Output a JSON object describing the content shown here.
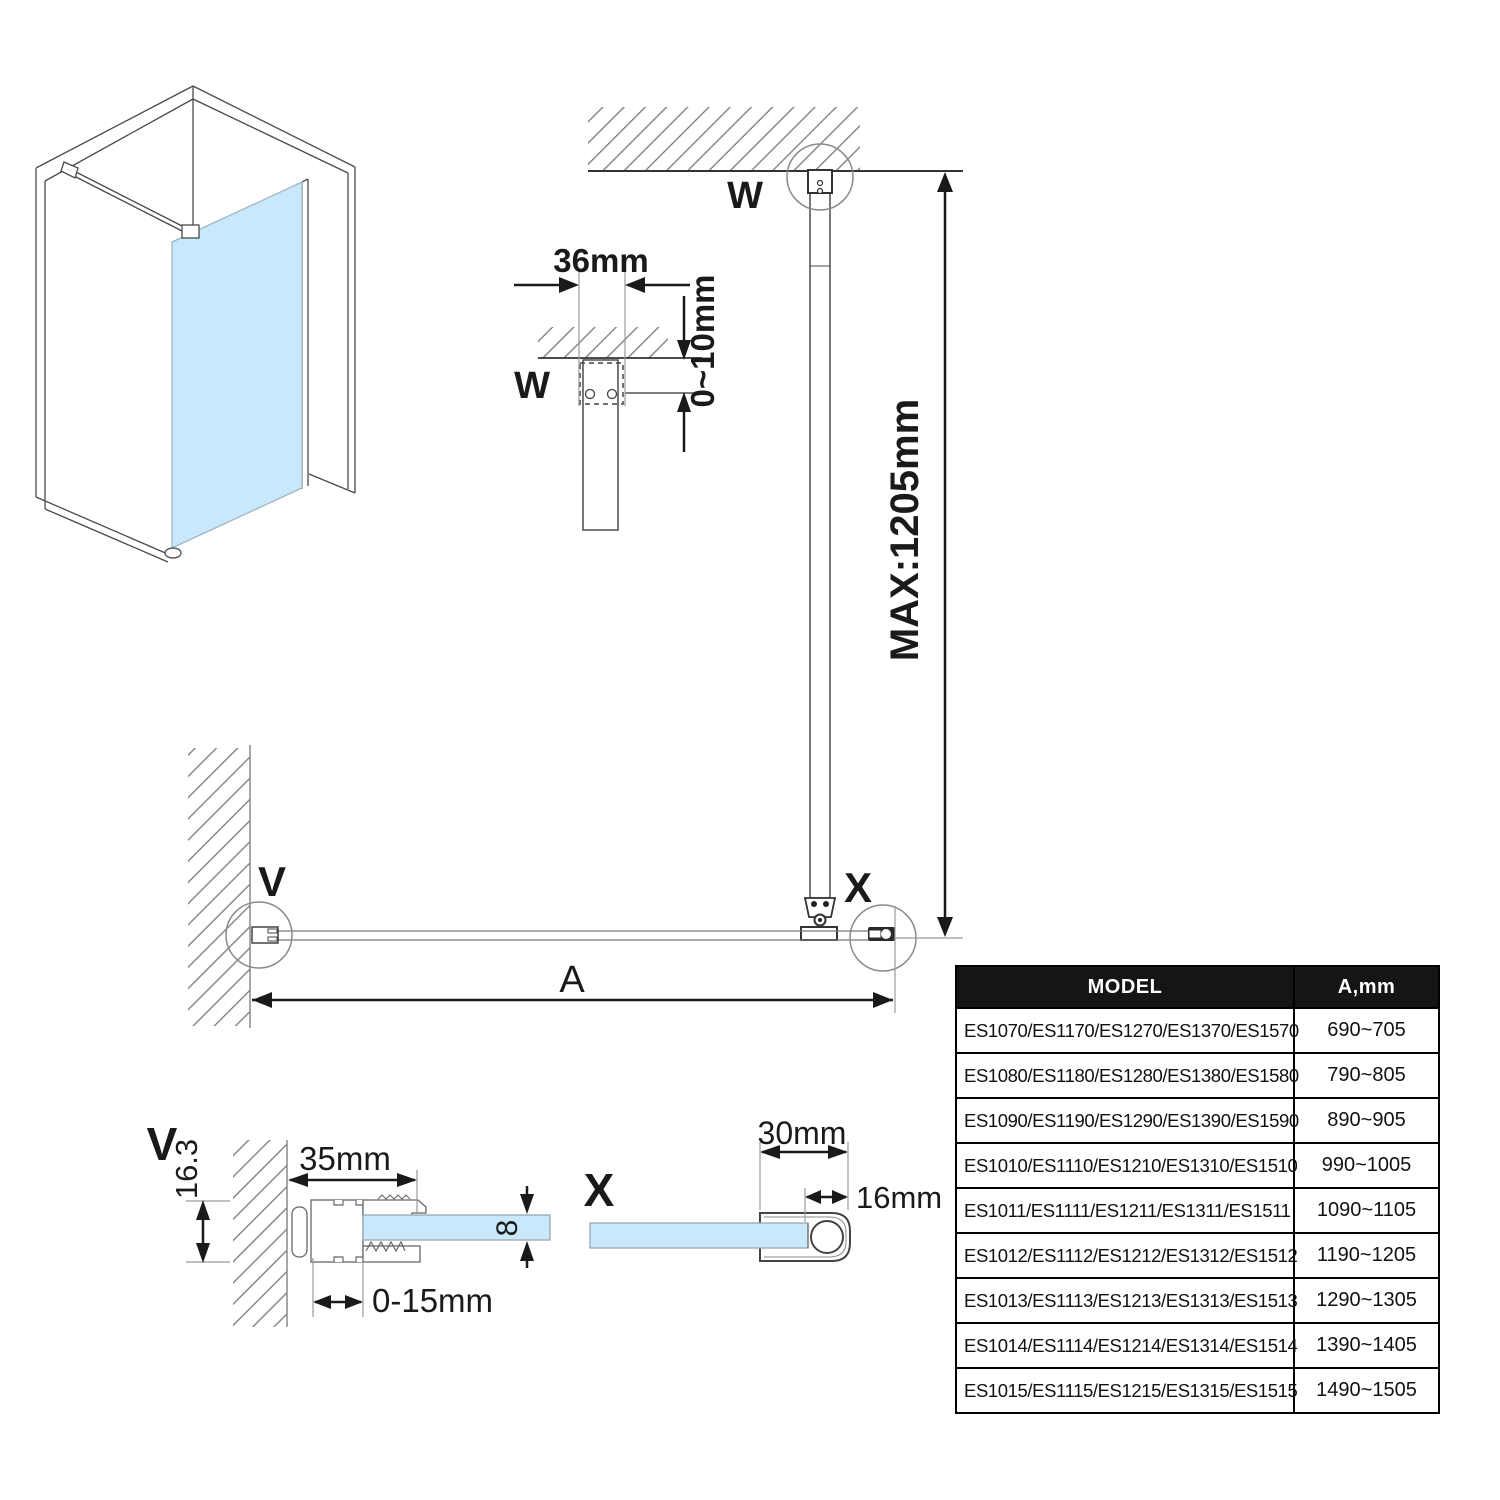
{
  "diagram": {
    "labels": {
      "w_main": "W",
      "w_small": "W",
      "v_plan": "V",
      "x_plan": "X",
      "v_section": "V",
      "x_section": "X",
      "dim_a": "A"
    },
    "dimensions": {
      "bracket_width": "36mm",
      "ceiling_gap": "0~10mm",
      "max_bar_length": "MAX:1205mm",
      "wall_profile_width": "35mm",
      "wall_profile_height": "16.3",
      "adjustment_range": "0-15mm",
      "glass_thickness": "8",
      "bar_depth": "30mm",
      "bar_width": "16mm"
    },
    "colors": {
      "glass": "#c9e8fb",
      "line_dark": "#333333",
      "line_gray": "#8a8a8a",
      "table_header_bg": "#151515"
    }
  },
  "table": {
    "headers": {
      "model": "MODEL",
      "a": "A,mm"
    },
    "rows": [
      {
        "model": "ES1070/ES1170/ES1270/ES1370/ES1570",
        "a": "690~705"
      },
      {
        "model": "ES1080/ES1180/ES1280/ES1380/ES1580",
        "a": "790~805"
      },
      {
        "model": "ES1090/ES1190/ES1290/ES1390/ES1590",
        "a": "890~905"
      },
      {
        "model": "ES1010/ES1110/ES1210/ES1310/ES1510",
        "a": "990~1005"
      },
      {
        "model": "ES1011/ES1111/ES1211/ES1311/ES1511",
        "a": "1090~1105"
      },
      {
        "model": "ES1012/ES1112/ES1212/ES1312/ES1512",
        "a": "1190~1205"
      },
      {
        "model": "ES1013/ES1113/ES1213/ES1313/ES1513",
        "a": "1290~1305"
      },
      {
        "model": "ES1014/ES1114/ES1214/ES1314/ES1514",
        "a": "1390~1405"
      },
      {
        "model": "ES1015/ES1115/ES1215/ES1315/ES1515",
        "a": "1490~1505"
      }
    ]
  }
}
